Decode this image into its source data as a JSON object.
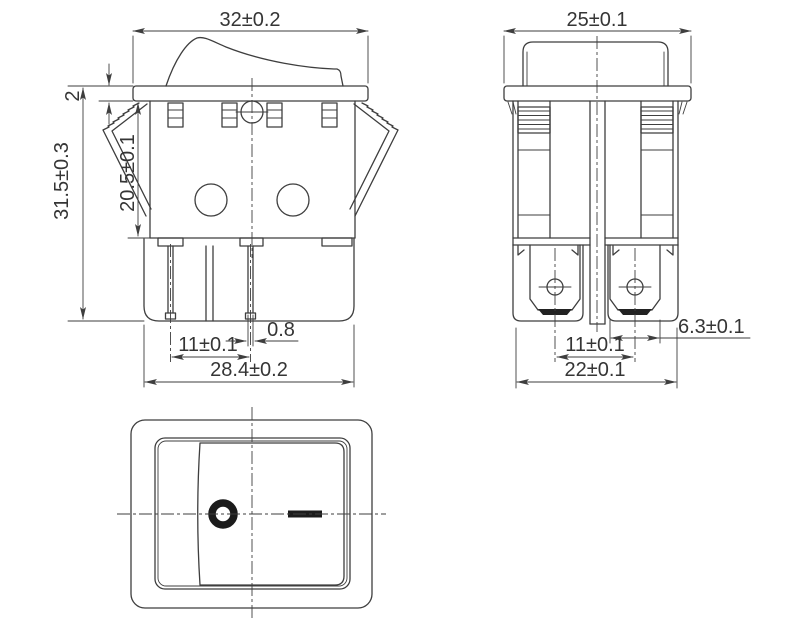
{
  "drawing": {
    "kind": "rocker-switch-dimension-drawing",
    "background": "#ffffff",
    "line_color": "#3e3e3e",
    "symbol_color": "#1b1b1b"
  },
  "dimensions": {
    "front": {
      "width": "32±0.2",
      "flange_thickness": "2",
      "mount_depth": "20.5±0.1",
      "total_height": "31.5±0.3",
      "pin_thickness": "0.8",
      "pin_spacing": "11±0.1",
      "lower_body_width": "28.4±0.2"
    },
    "side": {
      "width": "25±0.1",
      "terminal_width": "6.3±0.1",
      "terminal_spacing": "11±0.1",
      "body_width": "22±0.1"
    }
  },
  "rocker_symbols": {
    "off": "O",
    "on": "—"
  }
}
